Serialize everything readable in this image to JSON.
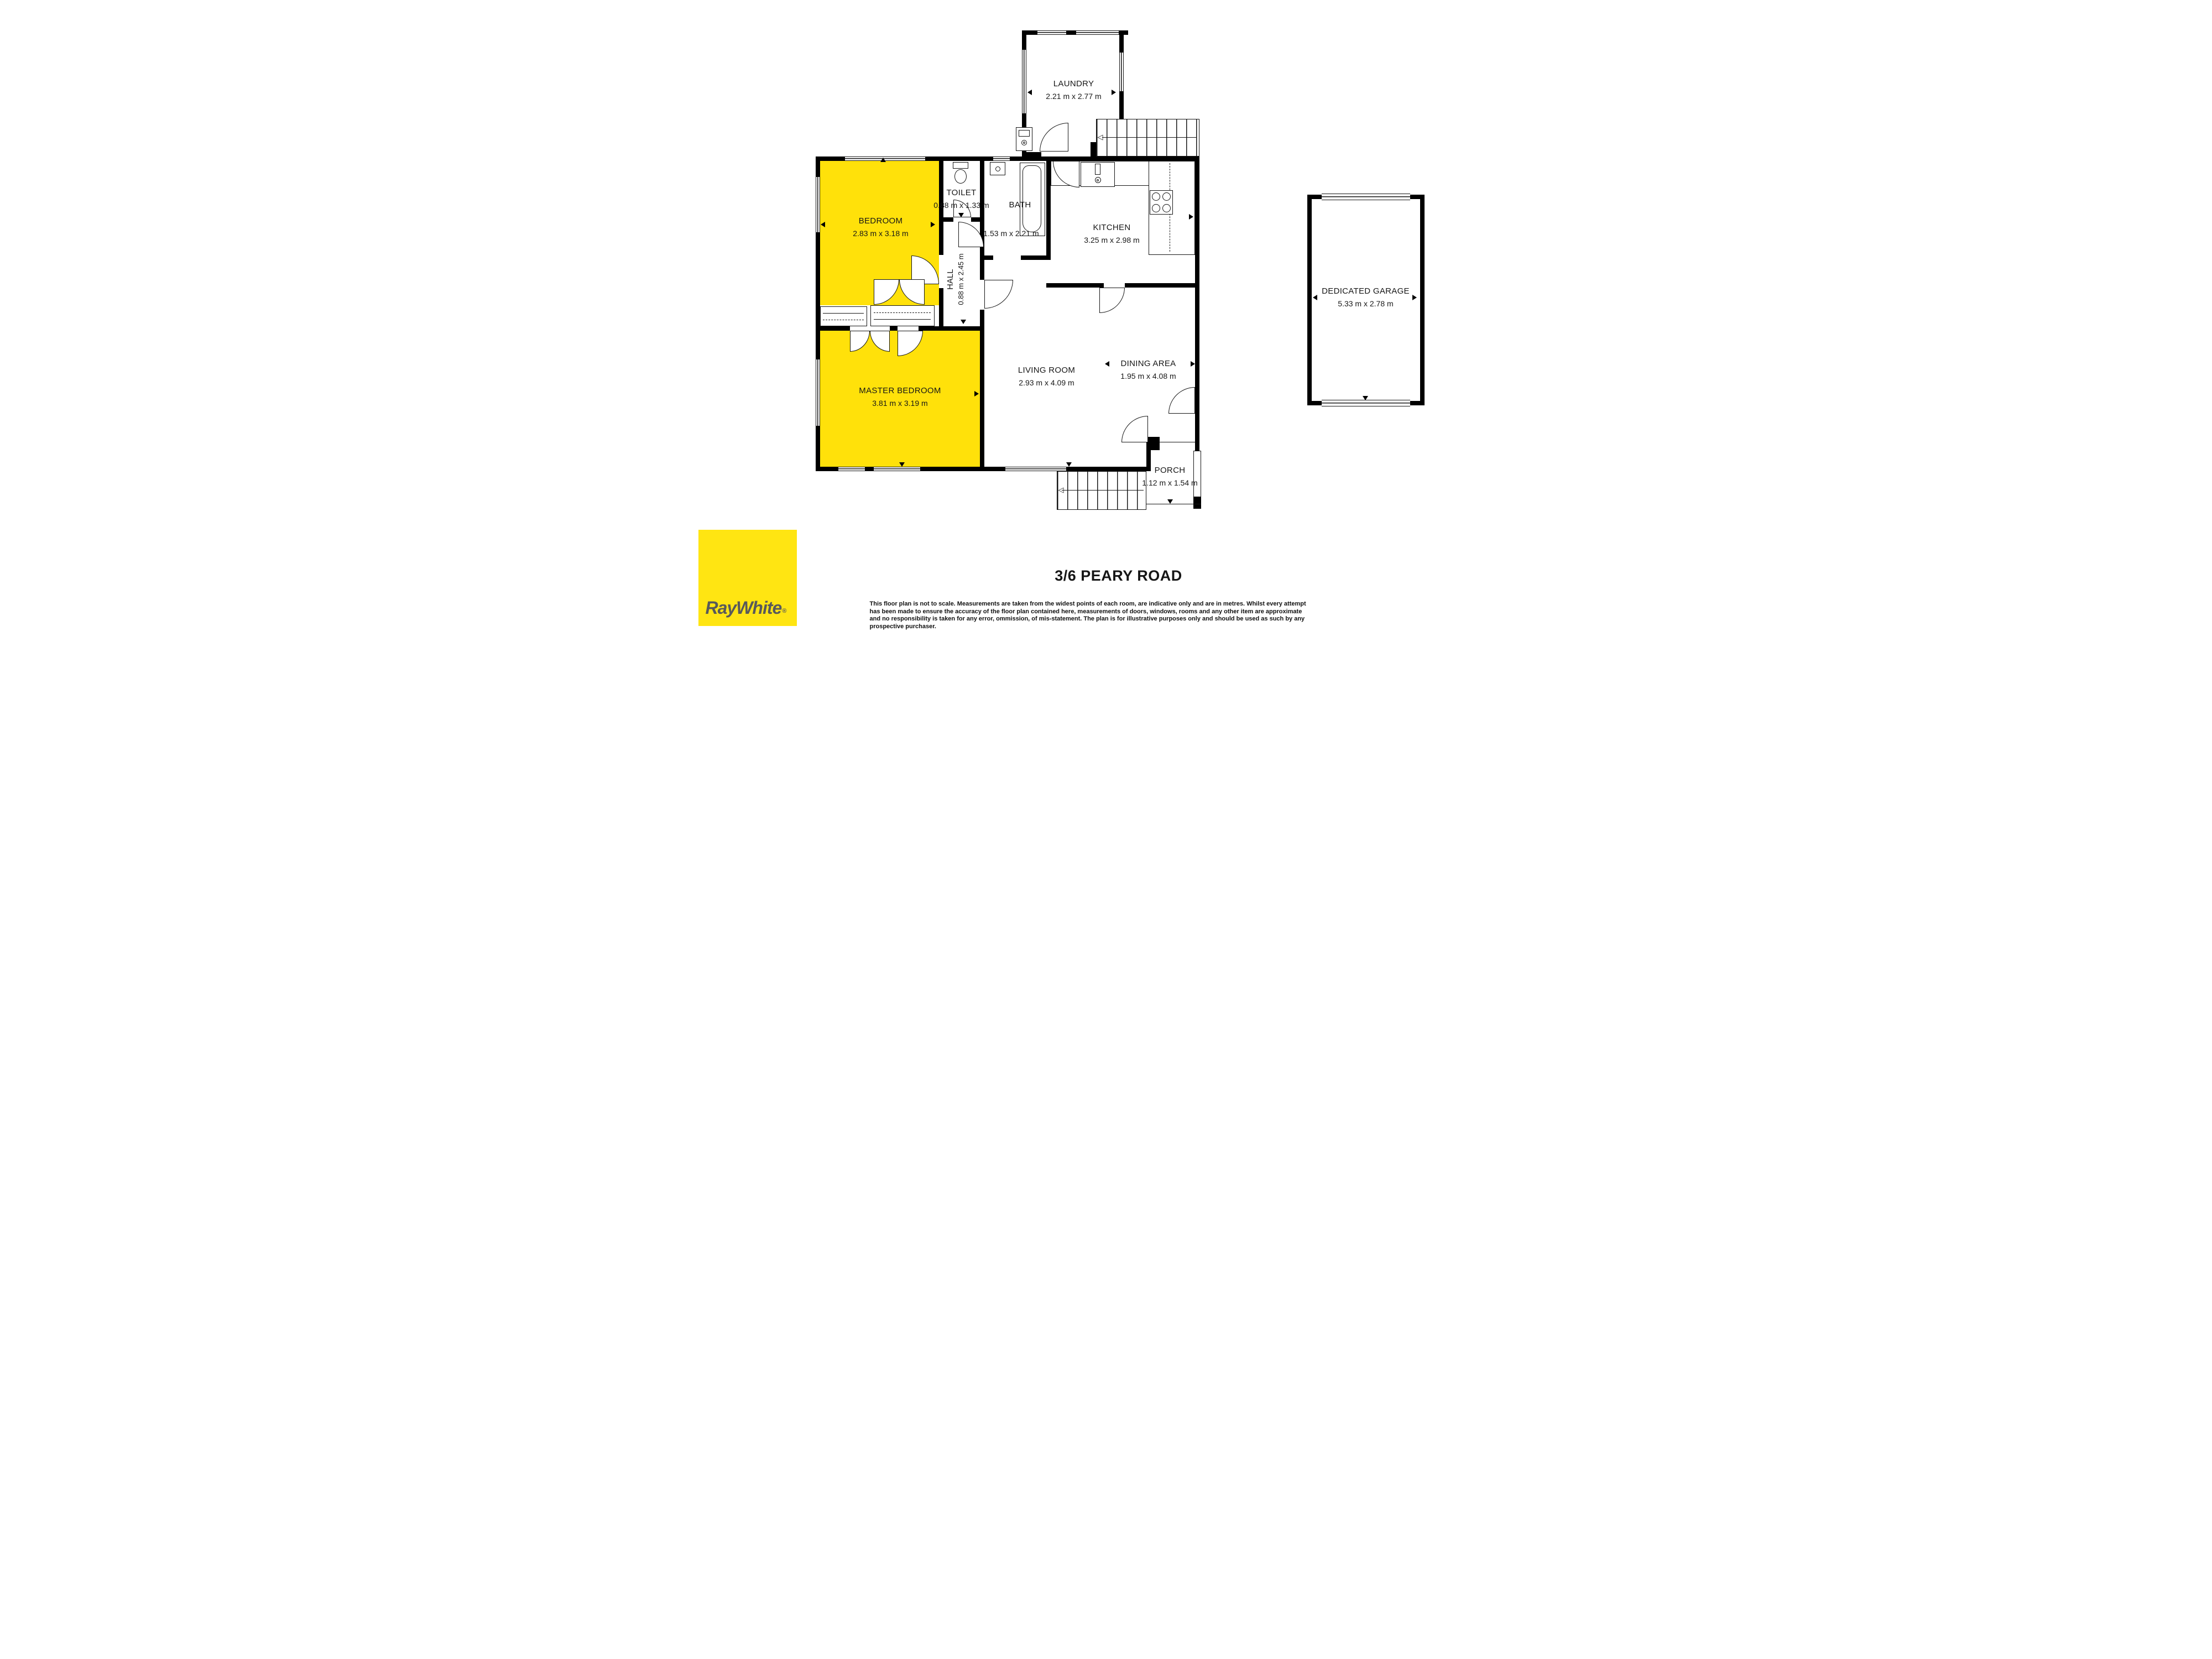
{
  "floorplan": {
    "rooms": {
      "laundry": {
        "label": "LAUNDRY",
        "dims": "2.21 m x 2.77 m"
      },
      "bedroom": {
        "label": "BEDROOM",
        "dims": "2.83 m x 3.18 m"
      },
      "toilet": {
        "label": "TOILET",
        "dims": "0.88 m x 1.33 m"
      },
      "bath": {
        "label": "BATH",
        "dims": "1.53 m x 2.21 m"
      },
      "kitchen": {
        "label": "KITCHEN",
        "dims": "3.25 m x 2.98 m"
      },
      "hall": {
        "label": "HALL",
        "dims": "0.88 m x 2.45 m"
      },
      "master_bedroom": {
        "label": "MASTER BEDROOM",
        "dims": "3.81 m x 3.19 m"
      },
      "living_room": {
        "label": "LIVING ROOM",
        "dims": "2.93 m x 4.09 m"
      },
      "dining_area": {
        "label": "DINING AREA",
        "dims": "1.95 m x 4.08 m"
      },
      "garage": {
        "label": "DEDICATED GARAGE",
        "dims": "5.33 m x 2.78 m"
      },
      "porch": {
        "label": "PORCH",
        "dims": "1.12 m x 1.54 m"
      }
    },
    "highlight_color": "#FFE10A",
    "wall_color": "#000000"
  },
  "footer": {
    "address": "3/6 PEARY ROAD",
    "disclaimer_lines": [
      "This floor plan is not to scale. Measurements are taken from the widest points of each room, are indicative only and are in metres. Whilst every attempt",
      "has been made to ensure the accuracy of the floor plan contained here, measurements of doors, windows, rooms and any other item are approximate",
      "and no responsibility is taken for any error, ommission, of mis-statement. The plan is for illustrative purposes only and should be used as such by any",
      "prospective purchaser."
    ],
    "logo": {
      "brand": "RayWhite",
      "registered_mark": "®",
      "background": "#FFE512",
      "text_color": "#58595B"
    }
  }
}
